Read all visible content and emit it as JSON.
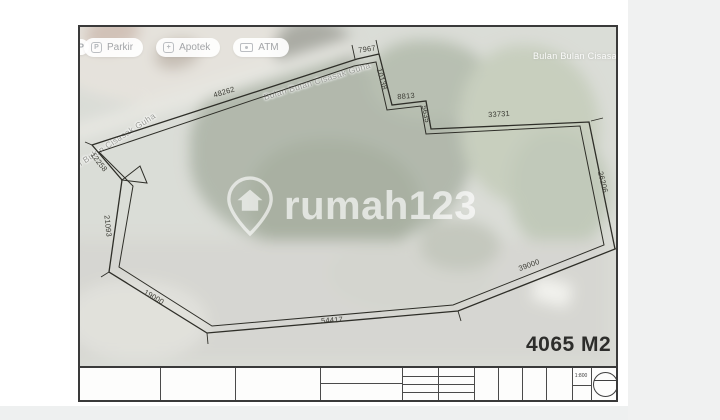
{
  "map_chips": {
    "partial_marker": "P",
    "items": [
      {
        "label": "Parkir"
      },
      {
        "label": "Apotek"
      },
      {
        "label": "ATM"
      }
    ]
  },
  "labels": {
    "street_main": "Bulan Bulan Cisasak Guha",
    "street_left": "Bulan Bulan Cisasak Guha",
    "place_top_right": "Bulan Bulan Cisasar"
  },
  "watermark": {
    "brand": "rumah123"
  },
  "plan": {
    "area": "4065 M2",
    "scale": "1:800",
    "dimensions": [
      {
        "name": "road-frontage",
        "value": "48262"
      },
      {
        "name": "top",
        "value": "7967"
      },
      {
        "name": "top-step-side",
        "value": "10138"
      },
      {
        "name": "top-step-bottom",
        "value": "8813"
      },
      {
        "name": "top-step-small",
        "value": "5635"
      },
      {
        "name": "north-east",
        "value": "33731"
      },
      {
        "name": "east",
        "value": "26206"
      },
      {
        "name": "south-east",
        "value": "39000"
      },
      {
        "name": "south",
        "value": "54417"
      },
      {
        "name": "south-west",
        "value": "19000"
      },
      {
        "name": "west",
        "value": "21093"
      },
      {
        "name": "north-west",
        "value": "12258"
      }
    ]
  },
  "colors": {
    "plot_line": "#2e2e28",
    "area_text": "#2d2d2b",
    "page_bg": "#f0f1f1",
    "satellite_base": "#c0c4ba"
  }
}
